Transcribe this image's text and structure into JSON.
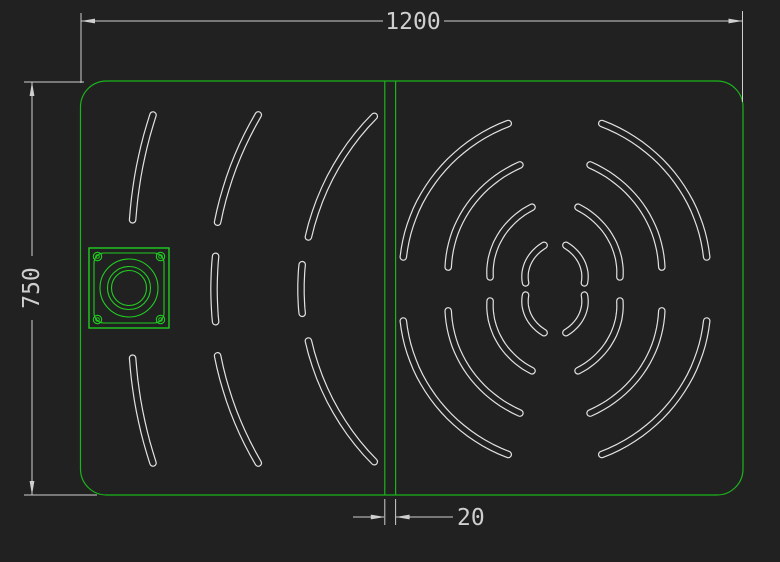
{
  "app": {
    "type": "cad-drawing-canvas",
    "background": "#212121"
  },
  "colors": {
    "panel_green": "#1bb51b",
    "fixture_green": "#21cd21",
    "slot_white": "#e2e2e2",
    "dimension_gray": "#cfcfcf",
    "background": "#212121"
  },
  "dimensions": {
    "width": {
      "label": "1200"
    },
    "height": {
      "label": "750"
    },
    "gap": {
      "label": "20"
    }
  },
  "drawing": {
    "panel": {
      "x": 80.5,
      "y": 81,
      "width": 662.5,
      "height": 414,
      "corner_radius": 26
    },
    "divider": {
      "xs": [
        384.8,
        395.6
      ],
      "y1": 81.5,
      "y2": 494.5
    },
    "ripple_center": {
      "x": 555,
      "y": 289
    },
    "slot_style": {
      "outer_width": 7.6,
      "inner_width": 5.2
    },
    "slots": [
      {
        "r1": 172,
        "r2": 155,
        "a1": 105.8,
        "a2": 168.1
      },
      {
        "r1": 129,
        "r2": 109,
        "a1": 105.8,
        "a2": 168.4
      },
      {
        "r1": 85,
        "r2": 66,
        "a1": 105.7,
        "a2": 169.5
      },
      {
        "r1": 45,
        "r2": 30,
        "a1": 104.0,
        "a2": 168.3
      },
      {
        "r1": 172,
        "r2": 155,
        "a1": 74.2,
        "a2": 11.9
      },
      {
        "r1": 129,
        "r2": 109,
        "a1": 74.2,
        "a2": 11.6
      },
      {
        "r1": 85,
        "r2": 66,
        "a1": 74.3,
        "a2": 10.5
      },
      {
        "r1": 45,
        "r2": 30,
        "a1": 76.0,
        "a2": 11.7
      },
      {
        "r1": 172,
        "r2": 155,
        "a1": 254.2,
        "a2": 191.9
      },
      {
        "r1": 129,
        "r2": 109,
        "a1": 254.2,
        "a2": 191.6
      },
      {
        "r1": 85,
        "r2": 66,
        "a1": 254.3,
        "a2": 190.5
      },
      {
        "r1": 45,
        "r2": 30,
        "a1": 256.0,
        "a2": 191.7
      },
      {
        "r1": 172,
        "r2": 155,
        "a1": 285.8,
        "a2": 348.1
      },
      {
        "r1": 129,
        "r2": 109,
        "a1": 285.8,
        "a2": 348.4
      },
      {
        "r1": 85,
        "r2": 66,
        "a1": 285.7,
        "a2": 349.5
      },
      {
        "r1": 45,
        "r2": 30,
        "a1": 284.0,
        "a2": 348.3
      },
      {
        "r1": 438,
        "r2": 428,
        "a1": 156.6,
        "a2": 170.7
      },
      {
        "r1": 344,
        "r2": 344,
        "a1": 149.6,
        "a2": 168.8
      },
      {
        "r1": 250,
        "r2": 252,
        "a1": 136.3,
        "a2": 168.1
      },
      {
        "r1": 341,
        "r2": 341,
        "a1": 174.5,
        "a2": 185.5
      },
      {
        "r1": 254,
        "r2": 254,
        "a1": 174.5,
        "a2": 185.5
      },
      {
        "r1": 438,
        "r2": 428,
        "a1": 203.4,
        "a2": 189.3
      },
      {
        "r1": 344,
        "r2": 344,
        "a1": 210.4,
        "a2": 191.2
      },
      {
        "r1": 250,
        "r2": 252,
        "a1": 223.7,
        "a2": 191.9
      }
    ],
    "fixture": {
      "outer_square": {
        "x": 89,
        "y": 248,
        "size": 80
      },
      "rounded_square": {
        "x": 94,
        "y": 253,
        "size": 70,
        "radius": 10
      },
      "center": {
        "x": 129,
        "y": 288
      },
      "circle_radii": [
        29,
        21.5,
        17.5
      ],
      "bolt_holes": {
        "centers": [
          [
            97.5,
            256.5
          ],
          [
            160.5,
            256.5
          ],
          [
            97.5,
            319.5
          ],
          [
            160.5,
            319.5
          ]
        ],
        "radius": 4.2,
        "inner_radius": 1.8
      }
    },
    "dims": {
      "width": {
        "lines": [
          [
            81,
            21,
            383,
            21
          ],
          [
            444,
            21,
            742.5,
            21
          ],
          [
            81,
            13,
            81,
            83
          ],
          [
            742.5,
            11,
            742.5,
            102
          ]
        ],
        "arrows": [
          {
            "x": 81,
            "y": 21,
            "dir": "left"
          },
          {
            "x": 742.5,
            "y": 21,
            "dir": "right"
          }
        ]
      },
      "height": {
        "lines": [
          [
            32,
            82,
            32,
            256
          ],
          [
            32,
            320,
            32,
            495
          ],
          [
            24,
            82,
            84,
            82
          ],
          [
            24,
            495,
            97,
            495
          ]
        ],
        "arrows": [
          {
            "x": 32,
            "y": 82,
            "dir": "up"
          },
          {
            "x": 32,
            "y": 495,
            "dir": "down"
          }
        ]
      },
      "gap": {
        "lines": [
          [
            353,
            517,
            384,
            517
          ],
          [
            396,
            517,
            453,
            517
          ],
          [
            384.8,
            499,
            384.8,
            525
          ],
          [
            395.6,
            499,
            395.6,
            525
          ]
        ],
        "arrows": [
          {
            "x": 384.8,
            "y": 517,
            "dir": "right"
          },
          {
            "x": 395.6,
            "y": 517,
            "dir": "left"
          }
        ]
      },
      "arrow": {
        "length": 14,
        "half_width": 2.4
      }
    }
  }
}
